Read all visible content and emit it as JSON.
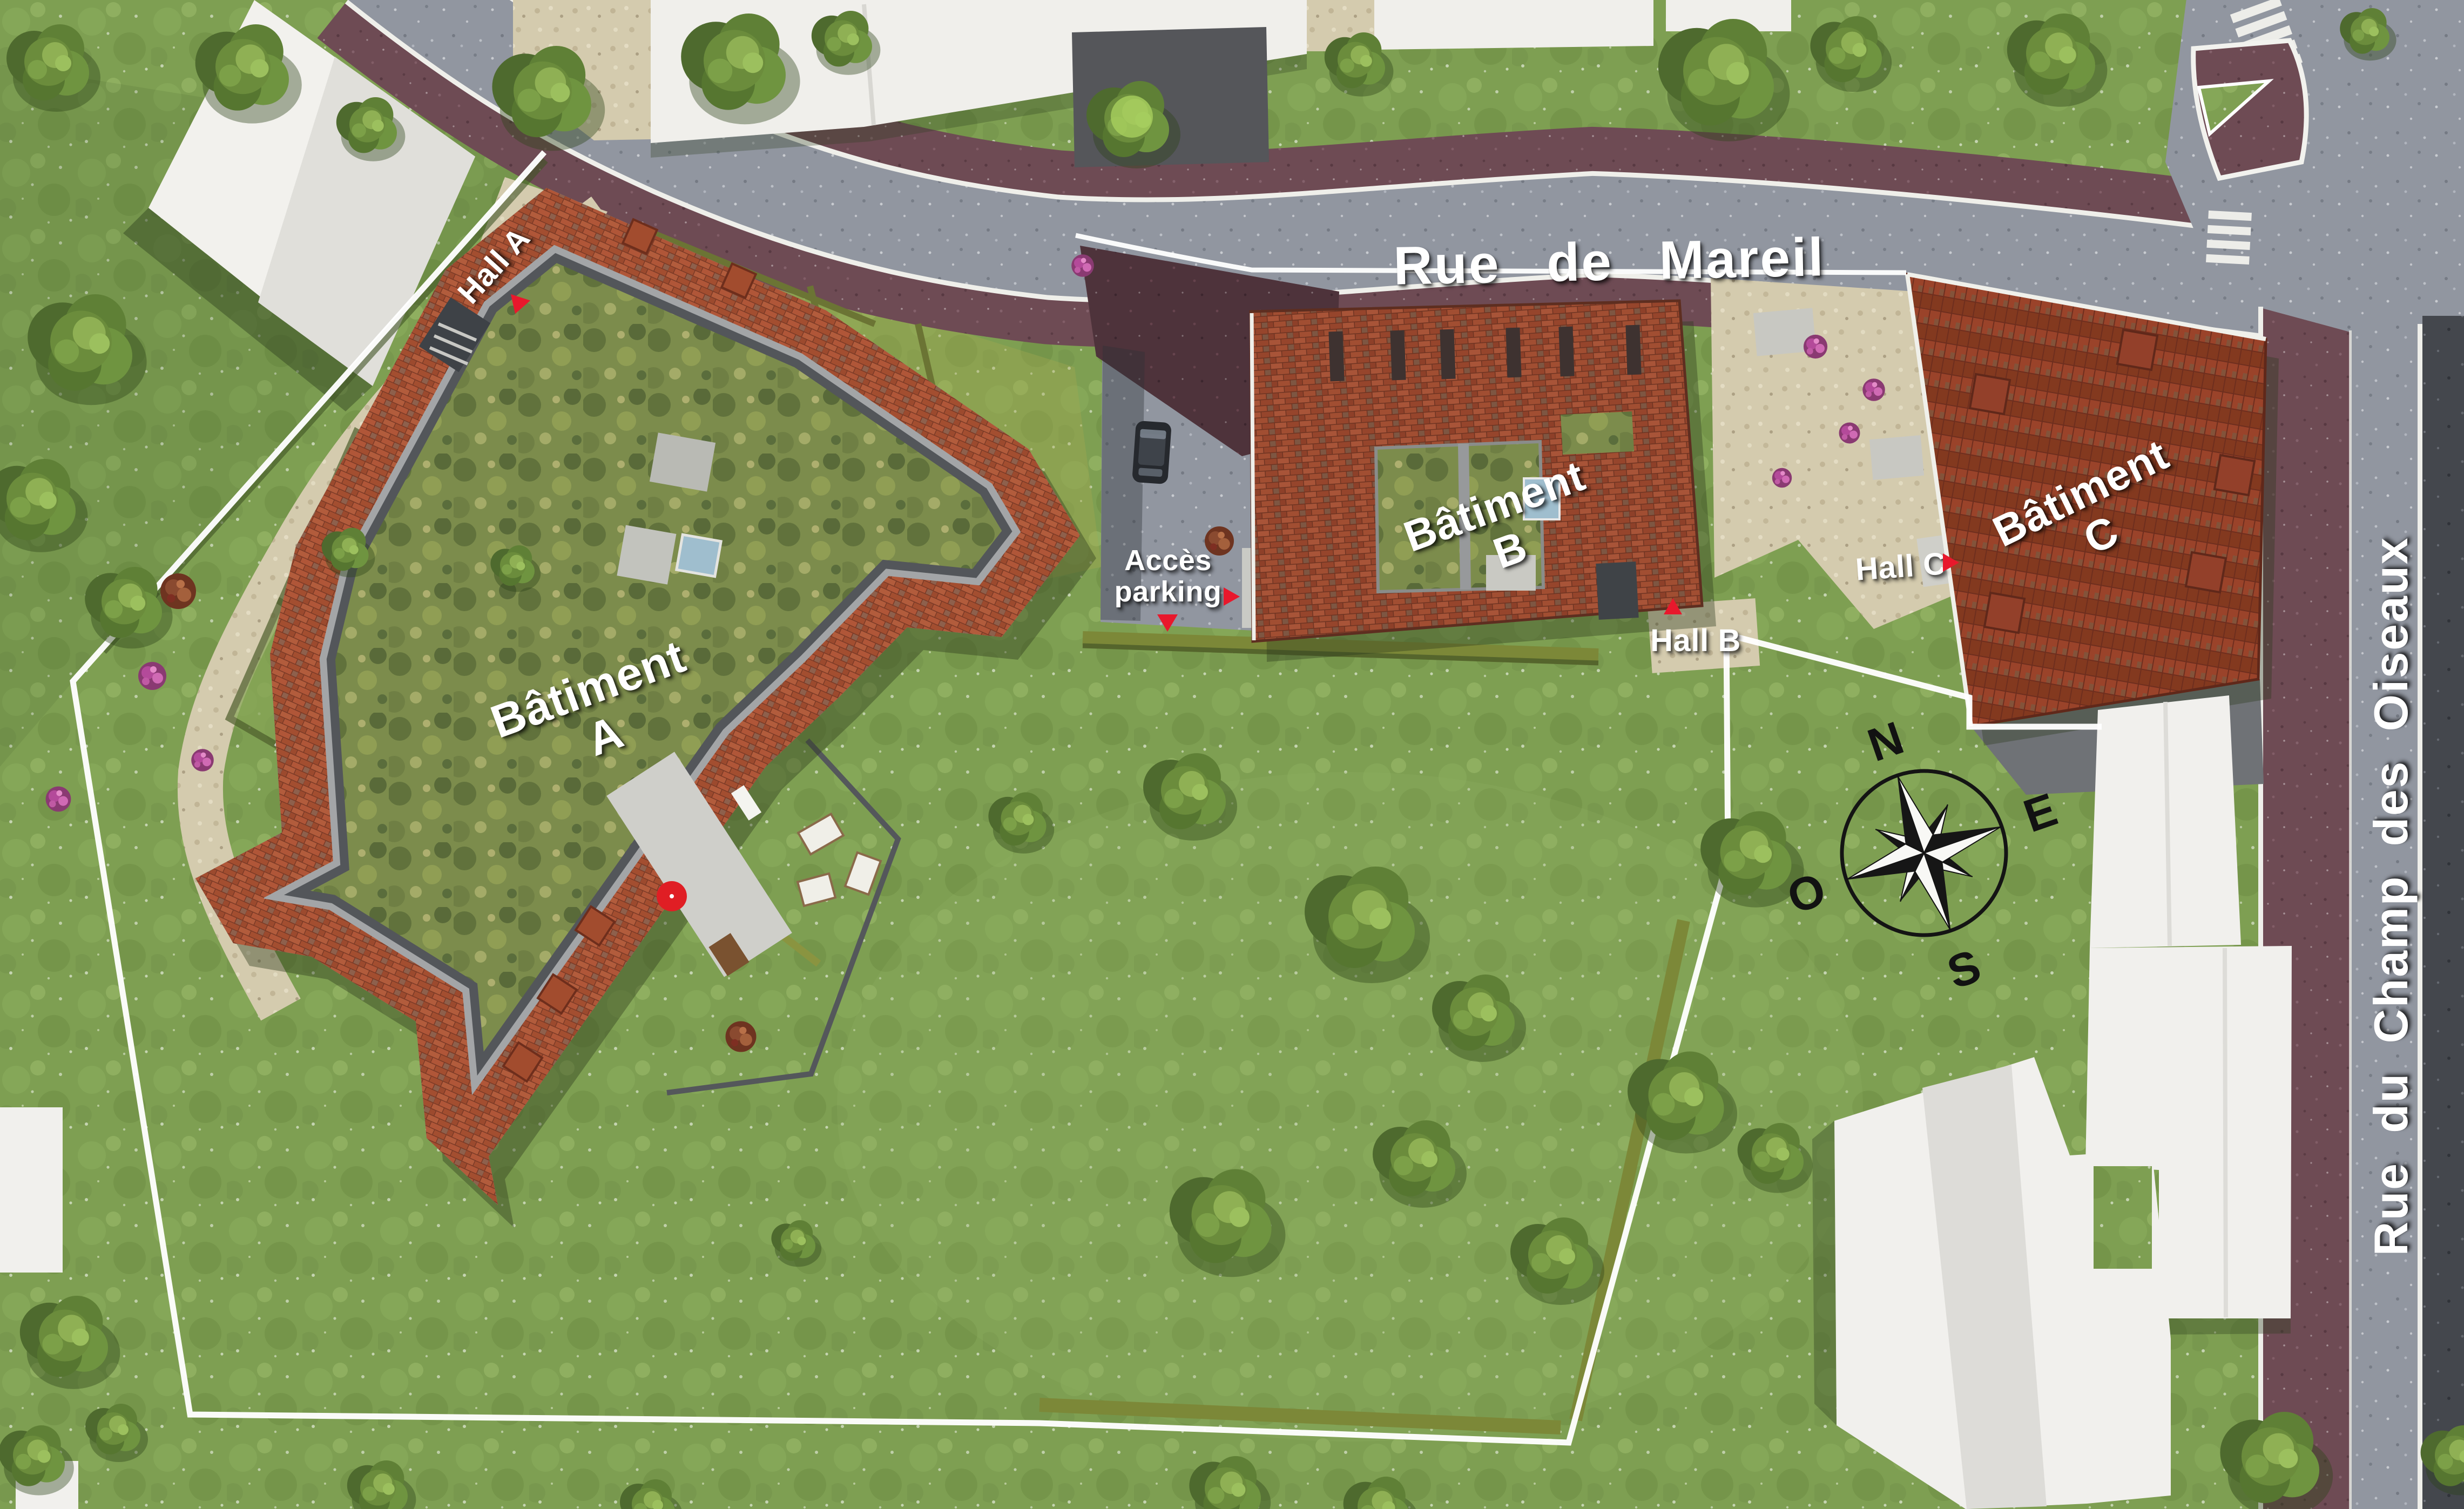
{
  "plan": {
    "streets": {
      "rue_de_mareil": "Rue de Mareil",
      "rue_du_champ_des_oiseaux": "Rue du Champ des Oiseaux"
    },
    "buildings": [
      {
        "name": "Bâtiment",
        "letter": "A",
        "hall": "Hall A"
      },
      {
        "name": "Bâtiment",
        "letter": "B",
        "hall": "Hall B"
      },
      {
        "name": "Bâtiment",
        "letter": "C",
        "hall": "Hall C"
      }
    ],
    "parking_access": {
      "line1": "Accès",
      "line2": "parking"
    },
    "compass": {
      "north": "N",
      "east": "E",
      "south": "S",
      "west": "O"
    },
    "colors": {
      "label_text": "#ffffff",
      "marker_red": "#e8182c",
      "roof_brick": "#a84e30",
      "green_roof": "#7c8c4c",
      "lawn": "#7e9f52",
      "road_asphalt": "#9196a0",
      "sidewalk_purple": "#6e4b54",
      "dark_lane": "#44474d",
      "white_building": "#f1f0ed",
      "gravel": "#d4cbae",
      "property_line": "#ffffff"
    }
  }
}
